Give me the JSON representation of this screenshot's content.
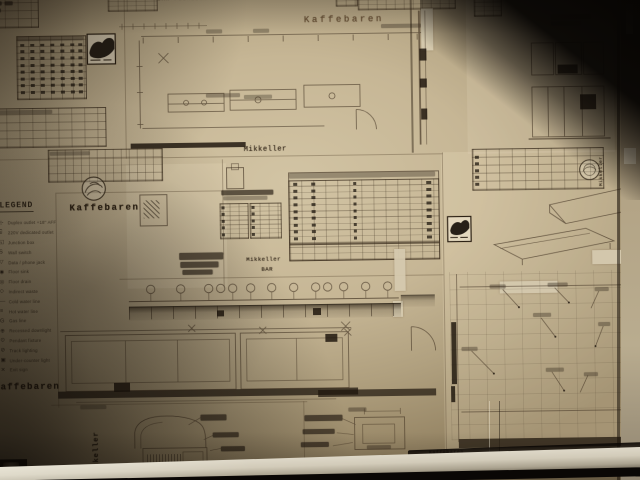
{
  "labels": {
    "kaffebaren_top": "Kaffebaren",
    "plumbing_note": "BAR PLUMBING DETAILS",
    "mikkeller_seam": "Mikkeller",
    "kaffebaren_mid_left": "Kaffebaren",
    "mikkeller_center": "Mikkeller",
    "bar_center": "BAR",
    "kaffebaren_bottom_left": "Kaffebaren",
    "mikkeller_vertical": "Mikkeller",
    "mikkeller_right_vertical": "Mikkeller",
    "kaffebaren_bottom_small": "Kaffebaren"
  },
  "legend": {
    "title": "LEGEND",
    "items": [
      {
        "symbol": "⊹",
        "label": "Duplex outlet +18\" AFF"
      },
      {
        "symbol": "⌸",
        "label": "220V dedicated outlet"
      },
      {
        "symbol": "◱",
        "label": "Junction box"
      },
      {
        "symbol": "S",
        "label": "Wall switch"
      },
      {
        "symbol": "▽",
        "label": "Data / phone jack"
      },
      {
        "symbol": "◉",
        "label": "Floor sink"
      },
      {
        "symbol": "◎",
        "label": "Floor drain"
      },
      {
        "symbol": "◇",
        "label": "Indirect waste"
      },
      {
        "symbol": "—",
        "label": "Cold water line"
      },
      {
        "symbol": "≡",
        "label": "Hot water line"
      },
      {
        "symbol": "G",
        "label": "Gas line"
      },
      {
        "symbol": "⊕",
        "label": "Recessed downlight"
      },
      {
        "symbol": "⊙",
        "label": "Pendant fixture"
      },
      {
        "symbol": "⊘",
        "label": "Track lighting"
      },
      {
        "symbol": "▣",
        "label": "Under-counter light"
      },
      {
        "symbol": "✕",
        "label": "Exit sign"
      }
    ]
  },
  "icons": {
    "square_stamp": "woodcut-logo-stamp",
    "round_stamp": "architect-round-stamp",
    "corner_photo": "corner-photo-stamp"
  },
  "colors": {
    "paper": "#c8ba9c",
    "ink": "#3e2f1f",
    "corner_shadow": "#070503",
    "ledge": "#d6d0c0"
  }
}
